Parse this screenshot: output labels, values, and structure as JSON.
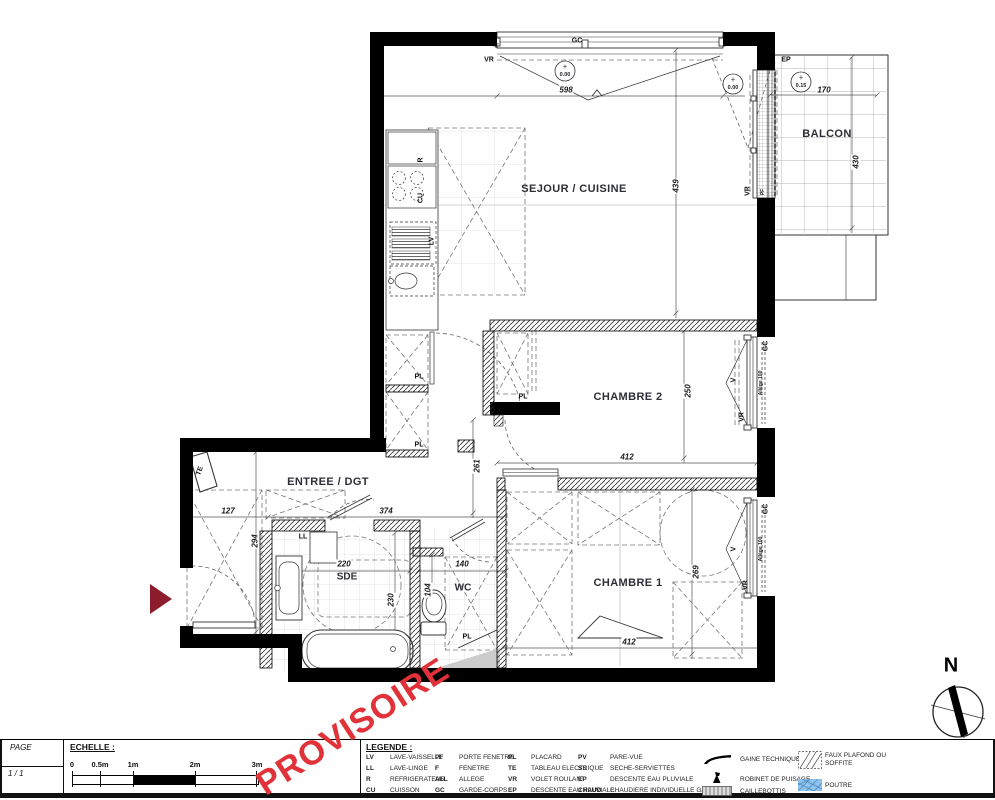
{
  "watermark": "PROVISOIRE",
  "compass": {
    "north": "N"
  },
  "colors": {
    "watermark_red": "#e03238",
    "entry_arrow_red": "#8c1d2c",
    "poutre_blue": "#8fc2ec"
  },
  "rooms": {
    "sejour": "SEJOUR / CUISINE",
    "balcon": "BALCON",
    "chambre2": "CHAMBRE 2",
    "chambre1": "CHAMBRE 1",
    "entree": "ENTREE / DGT",
    "sde": "SDE",
    "wc": "WC"
  },
  "dims": {
    "mur_haut": "598",
    "balcon_largeur": "170",
    "balcon_profondeur": "430",
    "sejour_profondeur": "439",
    "chambre2_profondeur": "250",
    "chambre2_largeur": "412",
    "couloir": "261",
    "entree_a": "127",
    "entree_b": "374",
    "entree_profondeur": "294",
    "sde_largeur": "220",
    "sde_profondeur": "230",
    "wc_largeur": "140",
    "wc_profondeur": "104",
    "chambre1_profondeur": "269",
    "chambre1_largeur": "412"
  },
  "levels": {
    "sejour": "0.00",
    "logement": "0.00",
    "balcon": "0.15"
  },
  "tags": {
    "vr": "VR",
    "gc": "GC",
    "f": "F",
    "ep": "EP",
    "pf": "PF",
    "v": "V",
    "r": "R",
    "cu": "CU",
    "lv": "LV",
    "ll": "LL",
    "te": "TE",
    "pl": "PL",
    "allege": "Allège 100"
  },
  "titleblock": {
    "page_label": "PAGE",
    "page_value": "1 / 1",
    "echelle_label": "ECHELLE :",
    "scale_ticks": [
      "0",
      "0.5m",
      "1m",
      "2m",
      "3m"
    ]
  },
  "legend": {
    "title": "LEGENDE :",
    "items": [
      {
        "abbr": "LV",
        "label": "LAVE-VAISSELLE"
      },
      {
        "abbr": "LL",
        "label": "LAVE-LINGE"
      },
      {
        "abbr": "R",
        "label": "REFRIGERATEUR"
      },
      {
        "abbr": "CU",
        "label": "CUISSON"
      },
      {
        "abbr": "PF",
        "label": "PORTE FENETRE"
      },
      {
        "abbr": "F",
        "label": "FENETRE"
      },
      {
        "abbr": "ALL",
        "label": "ALLEGE"
      },
      {
        "abbr": "GC",
        "label": "GARDE-CORPS"
      },
      {
        "abbr": "PL",
        "label": "PLACARD"
      },
      {
        "abbr": "TE",
        "label": "TABLEAU ELECTRIQUE"
      },
      {
        "abbr": "VR",
        "label": "VOLET ROULANT"
      },
      {
        "abbr": "EP",
        "label": "DESCENTE EAU PLUVIALE"
      },
      {
        "abbr": "PV",
        "label": "PARE-VUE"
      },
      {
        "abbr": "SS",
        "label": "SECHE-SERVIETTES"
      },
      {
        "abbr": "EP",
        "label": "DESCENTE EAU PLUVIALE"
      },
      {
        "abbr": "CHAUD",
        "label": "CHAUDIERE INDIVIDUELLE GAZ"
      }
    ],
    "symbols": [
      "GAINE TECHNIQUE",
      "ROBINET DE PUISAGE",
      "CAILLEBOTTIS",
      "FAUX PLAFOND OU SOFFITE",
      "POUTRE"
    ]
  }
}
